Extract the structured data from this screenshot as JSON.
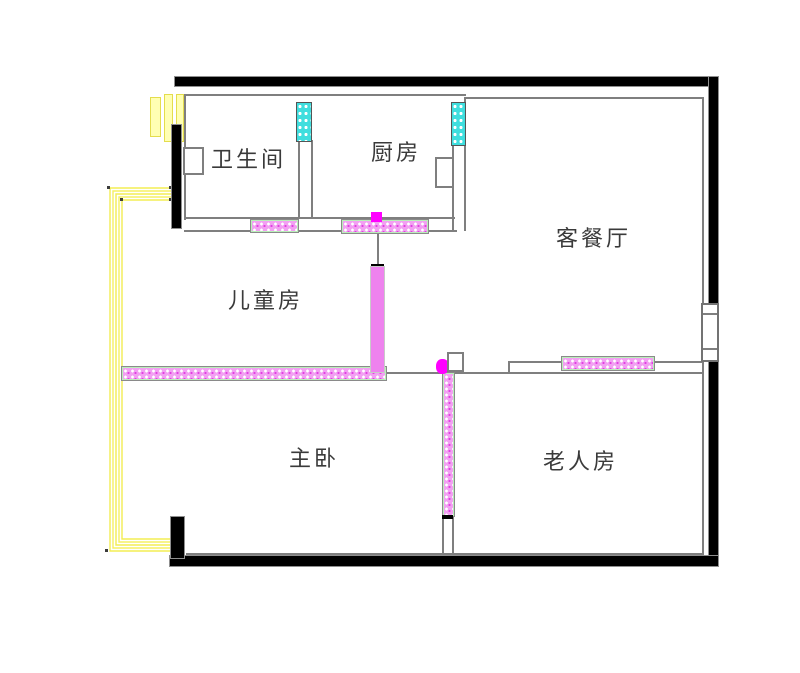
{
  "floor_plan": {
    "type": "apartment-floor-plan",
    "rooms": [
      {
        "id": "bathroom",
        "label": "卫生间"
      },
      {
        "id": "kitchen",
        "label": "厨房"
      },
      {
        "id": "living-dining",
        "label": "客餐厅"
      },
      {
        "id": "children-room",
        "label": "儿童房"
      },
      {
        "id": "master-bedroom",
        "label": "主卧"
      },
      {
        "id": "elder-room",
        "label": "老人房"
      }
    ],
    "legend_colors": {
      "structural_wall_black": "#000000",
      "wall_line_gray": "#7f7f7f",
      "light_wall_hatch_pink": "#ee82ee",
      "marker_magenta": "#ff00ff",
      "vent_window_cyan": "#40e0d0",
      "cable_route_yellow": "#f3ed53",
      "duct_bar_yellow": "#ffffb3"
    }
  }
}
